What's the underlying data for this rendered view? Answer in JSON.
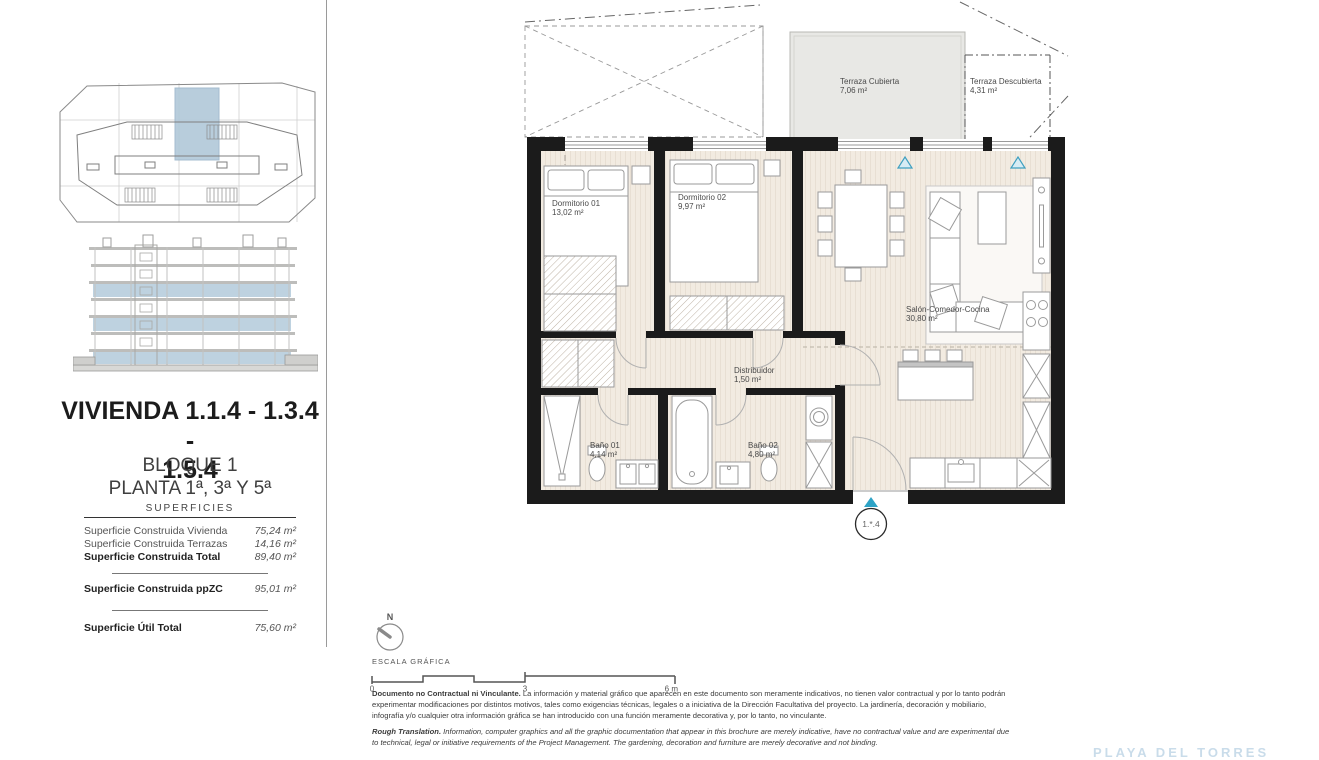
{
  "document": {
    "title_line1": "VIVIENDA 1.1.4 - 1.3.4 -",
    "title_line2": "1.5.4",
    "subtitle_line1": "BLOQUE 1",
    "subtitle_line2": "PLANTA 1ª, 3ª Y 5ª"
  },
  "surfaces": {
    "header": "SUPERFICIES",
    "rows": [
      {
        "label": "Superficie Construida Vivienda",
        "value": "75,24 m²"
      },
      {
        "label": "Superficie Construida Terrazas",
        "value": "14,16 m²"
      },
      {
        "label": "Superficie Construida Total",
        "value": "89,40 m²"
      },
      {
        "label": "Superficie Construida ppZC",
        "value": "95,01 m²"
      },
      {
        "label": "Superficie Útil Total",
        "value": "75,60 m²"
      }
    ]
  },
  "floor_plan": {
    "rooms": {
      "terraza_cubierta": {
        "name": "Terraza Cubierta",
        "area": "7,06 m²"
      },
      "terraza_descubierta": {
        "name": "Terraza Descubierta",
        "area": "4,31 m²"
      },
      "dormitorio_01": {
        "name": "Dormitorio 01",
        "area": "13,02 m²"
      },
      "dormitorio_02": {
        "name": "Dormitorio 02",
        "area": "9,97 m²"
      },
      "salon": {
        "name": "Salón-Comedor-Cocina",
        "area": "30,80 m²"
      },
      "distribuidor": {
        "name": "Distribuidor",
        "area": "1,50 m²"
      },
      "bano_01": {
        "name": "Baño 01",
        "area": "4,14 m²"
      },
      "bano_02": {
        "name": "Baño 02",
        "area": "4,80 m²"
      }
    },
    "unit_tag": "1.*.4"
  },
  "scale_bar": {
    "north": "N",
    "caption": "ESCALA GRÁFICA",
    "tick0": "0",
    "tick3": "3",
    "tick6": "6 m"
  },
  "legal": {
    "es_lead": "Documento no Contractual ni Vinculante.",
    "es_body": " La información y material gráfico que aparecen en este documento son meramente indicativos, no tienen valor contractual y por lo tanto podrán experimentar modificaciones por distintos motivos, tales como exigencias técnicas, legales o a iniciativa de la Dirección Facultativa del proyecto. La jardinería, decoración y mobiliario, infografía y/o cualquier otra información gráfica se han introducido con una función meramente decorativa y, por lo tanto, no vinculante.",
    "en_lead": "Rough Translation.",
    "en_body": " Information, computer graphics and all the graphic documentation that appear in this brochure are merely indicative, have no contractual value and are experimental due to technical, legal or initiative requirements of the Project Management. The gardening, decoration and furniture are merely decorative and not binding."
  },
  "watermark": "PLAYA DEL TORRES",
  "colors": {
    "wall": "#1b1b1b",
    "floor_beige": "#f2ebe1",
    "terrace_gray": "#e8e8e5",
    "highlight_blue": "#b3c9da",
    "triangle_teal": "#2ea3c6",
    "label_gray": "#4a4a4a"
  }
}
